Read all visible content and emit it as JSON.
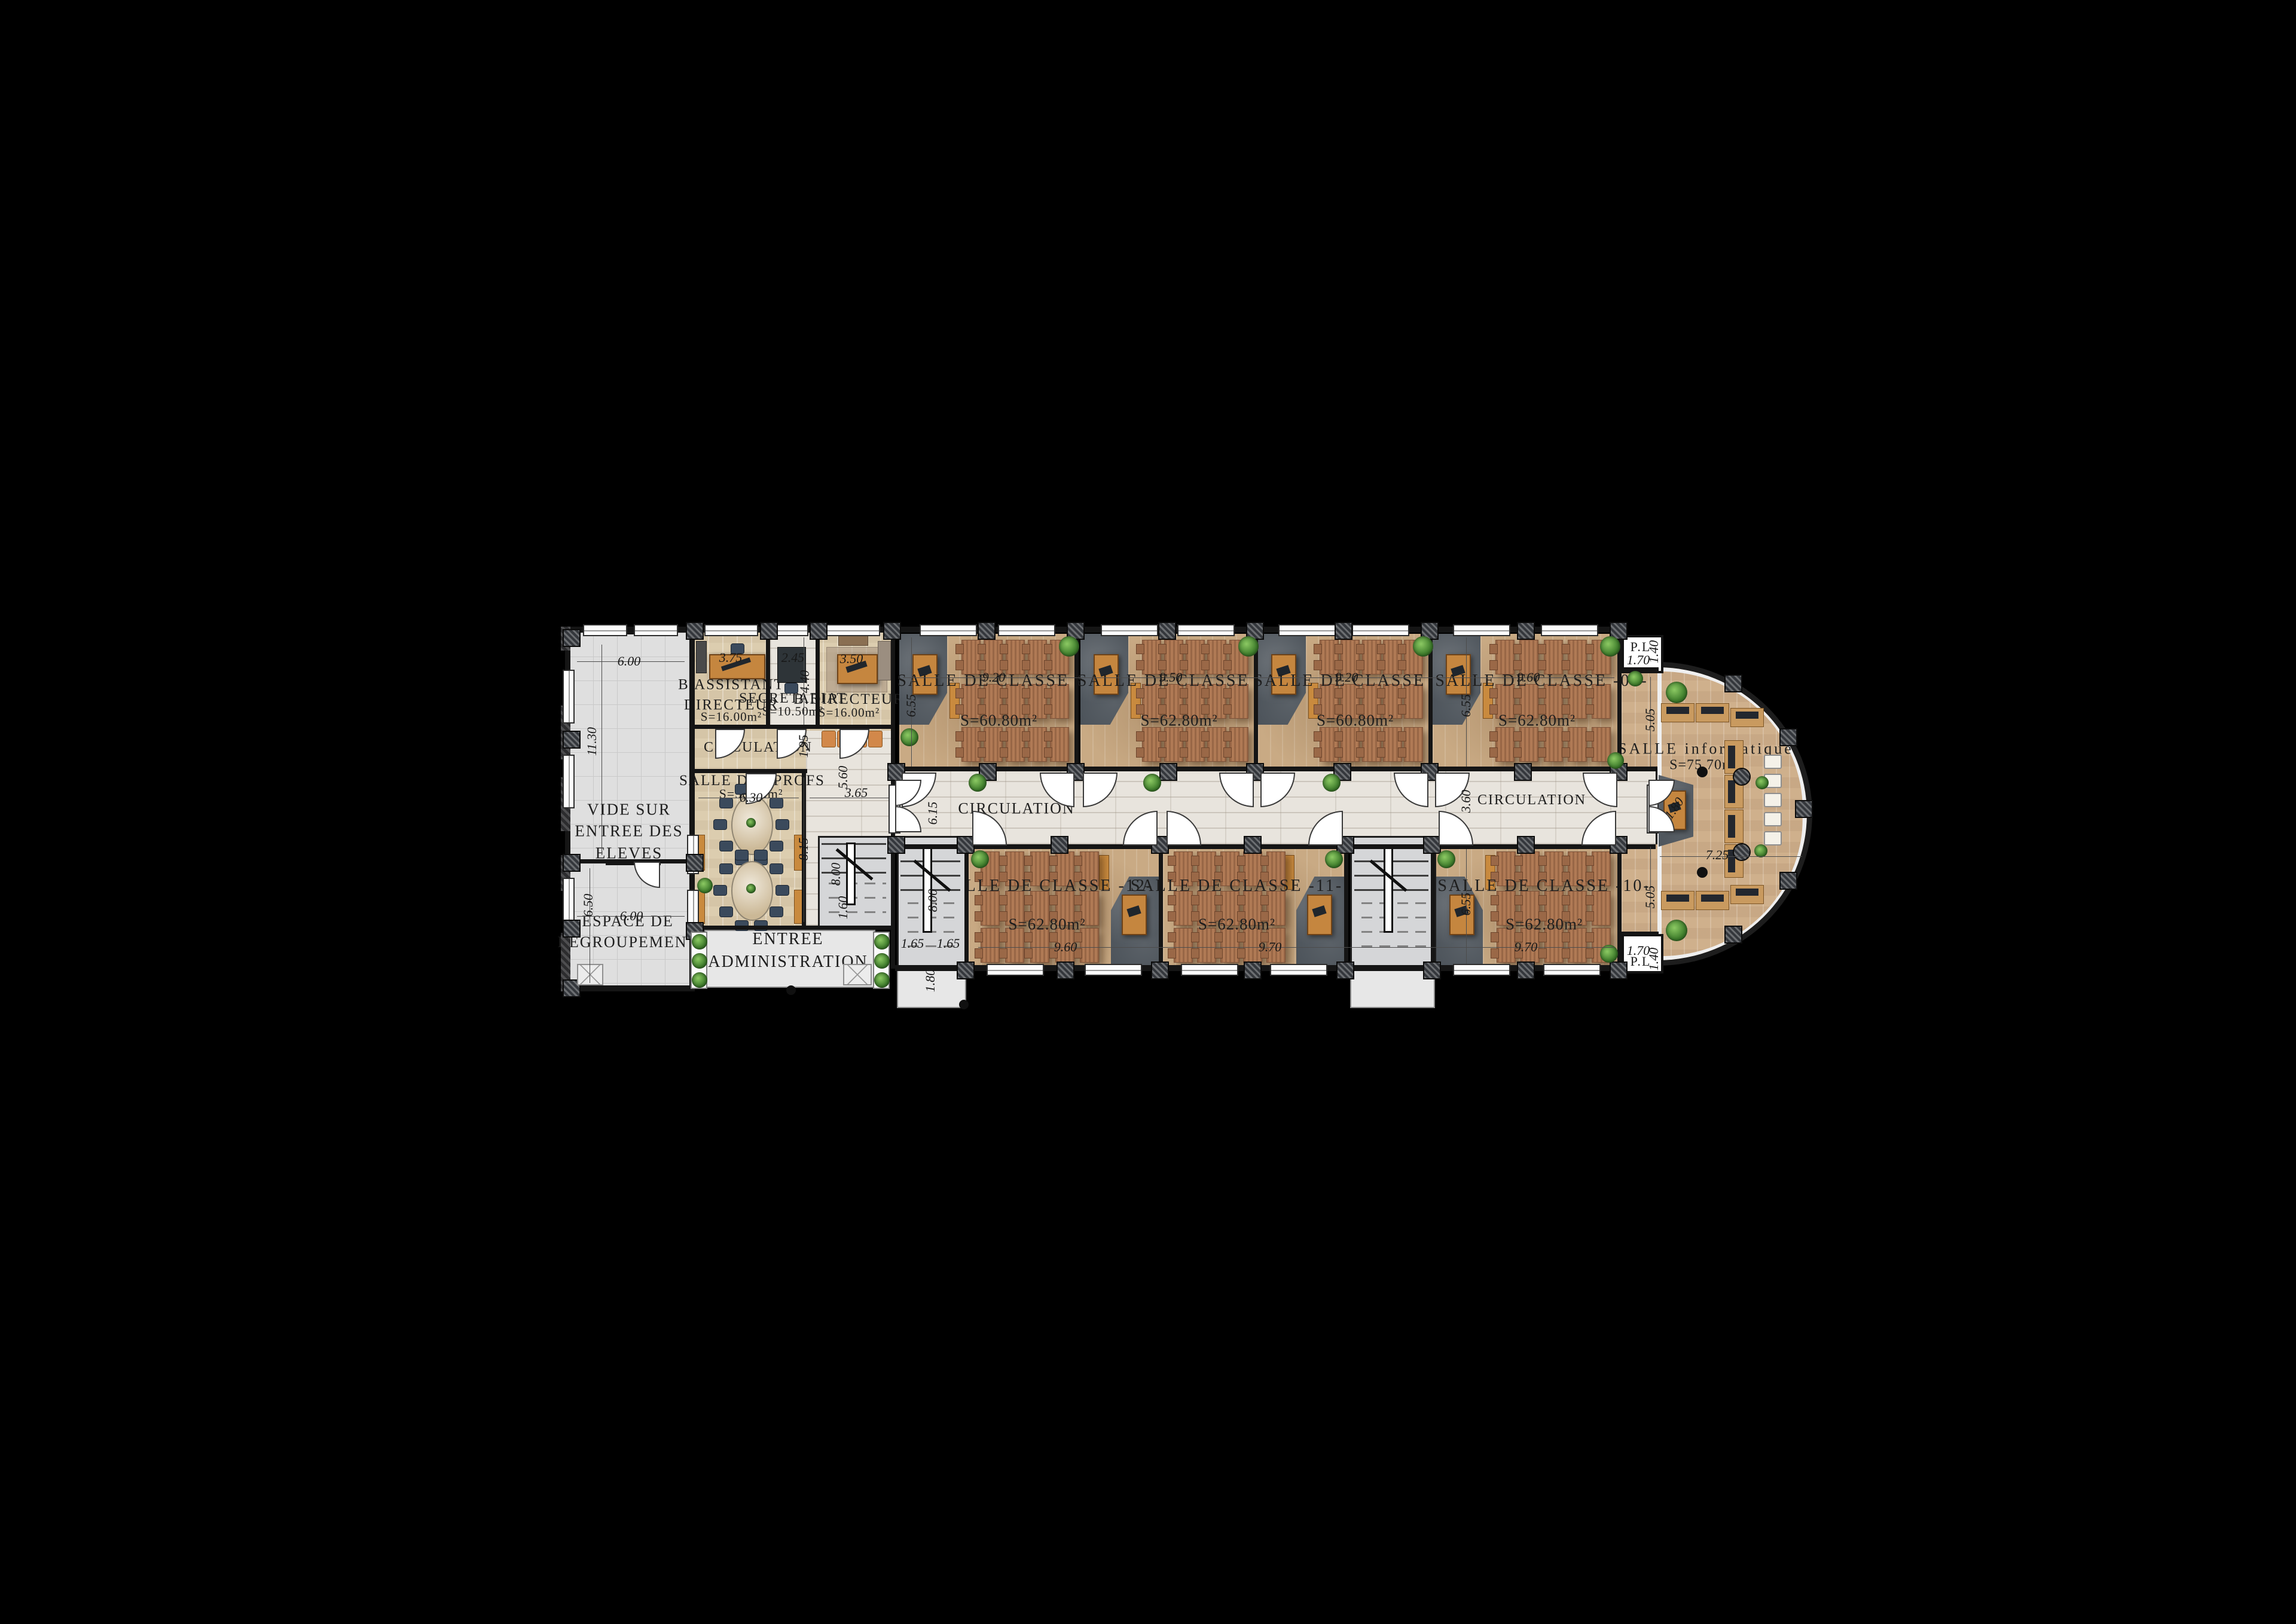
{
  "title": "Plan d'étage — établissement scolaire",
  "colors": {
    "background": "#000000",
    "classroom_floor": "#c9aa84",
    "corridor_floor": "#e8e4dd",
    "admin_floor": "#dccdaf",
    "info_floor": "#cfb08c",
    "court_floor": "#dfdfdf",
    "wall": "#151515",
    "teacher_corner": "#4d545b",
    "desk": "#b07a55",
    "accent_orange": "#c98a3e",
    "plant_green": "#3f7d2c",
    "chair_navy": "#3b4a5c"
  },
  "left_block": {
    "vide_label": "VIDE SUR ENTREE DES ELEVES",
    "espace_label": "ESPACE DE REGROUPEMENT"
  },
  "admin": {
    "assistant_title": "B.ASSISTANT DIRECTEUR",
    "assistant_area": "S=16.00m²",
    "secretariat_title": "SECRETARIAT",
    "secretariat_area": "S=10.50m²",
    "directeur_title": "B.DIRECTEUR",
    "directeur_area": "S=16.00m²",
    "circulation_label": "CIRCULATION",
    "profs_title": "SALLE DES PROFS",
    "profs_area": "S=50.25m²",
    "entree_label": "ENTREE ADMINISTRATION"
  },
  "wing": {
    "circulation_left": "CIRCULATION",
    "circulation_right": "CIRCULATION",
    "classrooms": [
      {
        "title": "SALLE DE CLASSE  -06-",
        "area": "S=60.80m²"
      },
      {
        "title": "SALLE DE CLASSE  -07-",
        "area": "S=62.80m²"
      },
      {
        "title": "SALLE DE CLASSE  -08-",
        "area": "S=60.80m²"
      },
      {
        "title": "SALLE DE CLASSE  -09-",
        "area": "S=62.80m²"
      },
      {
        "title": "SALLE DE CLASSE  -12-",
        "area": "S=62.80m²"
      },
      {
        "title": "SALLE DE CLASSE  -11-",
        "area": "S=62.80m²"
      },
      {
        "title": "SALLE DE CLASSE  -10-",
        "area": "S=62.80m²"
      }
    ],
    "informatique_title": "SALLE informatique",
    "informatique_area": "S=75.70m²",
    "pl_top": "P.L",
    "pl_bottom": "P.L",
    "desk_rows": 3,
    "desk_cols": 5
  },
  "dim_labels": [
    {
      "id": "vide-width",
      "text": "6.00"
    },
    {
      "id": "vide-height",
      "text": "11.30"
    },
    {
      "id": "espace-height",
      "text": "6.50"
    },
    {
      "id": "espace-width",
      "text": "6.00"
    },
    {
      "id": "assistant-width",
      "text": "3.75"
    },
    {
      "id": "secretariat-width",
      "text": "2.45"
    },
    {
      "id": "directeur-width",
      "text": "3.50"
    },
    {
      "id": "secretariat-depth",
      "text": "4.40"
    },
    {
      "id": "admin-circ-height",
      "text": "1.95"
    },
    {
      "id": "hall-height",
      "text": "5.60"
    },
    {
      "id": "hall-width",
      "text": "3.65"
    },
    {
      "id": "profs-width",
      "text": "6.30"
    },
    {
      "id": "profs-height",
      "text": "8.15"
    },
    {
      "id": "admin-stair-length",
      "text": "8.00"
    },
    {
      "id": "admin-stair-width",
      "text": "1.60"
    },
    {
      "id": "c06-width",
      "text": "9.20"
    },
    {
      "id": "c07-width",
      "text": "9.50"
    },
    {
      "id": "c08-width",
      "text": "9.20"
    },
    {
      "id": "c09-width",
      "text": "9.60"
    },
    {
      "id": "c06-height",
      "text": "6.55"
    },
    {
      "id": "c09-height",
      "text": "6.55"
    },
    {
      "id": "corridor-left-width",
      "text": "6.15"
    },
    {
      "id": "corridor-right-width",
      "text": "3.60"
    },
    {
      "id": "c12-width",
      "text": "9.60"
    },
    {
      "id": "c11-width",
      "text": "9.70"
    },
    {
      "id": "c10-width",
      "text": "9.70"
    },
    {
      "id": "c10-height",
      "text": "6.55"
    },
    {
      "id": "wstair-length",
      "text": "8.00"
    },
    {
      "id": "wstair-flight1",
      "text": "1.65"
    },
    {
      "id": "wstair-flight2",
      "text": "1.65"
    },
    {
      "id": "wstair-width",
      "text": "1.80"
    },
    {
      "id": "pl-top-width",
      "text": "1.70"
    },
    {
      "id": "pl-top-height",
      "text": "1.40"
    },
    {
      "id": "pl-bottom-width",
      "text": "1.70"
    },
    {
      "id": "pl-bottom-height",
      "text": "1.40"
    },
    {
      "id": "info-top-height",
      "text": "5.05"
    },
    {
      "id": "info-width",
      "text": "7.25"
    },
    {
      "id": "info-bottom-height",
      "text": "5.05"
    },
    {
      "id": "info-desk",
      "text": "1.80"
    }
  ]
}
